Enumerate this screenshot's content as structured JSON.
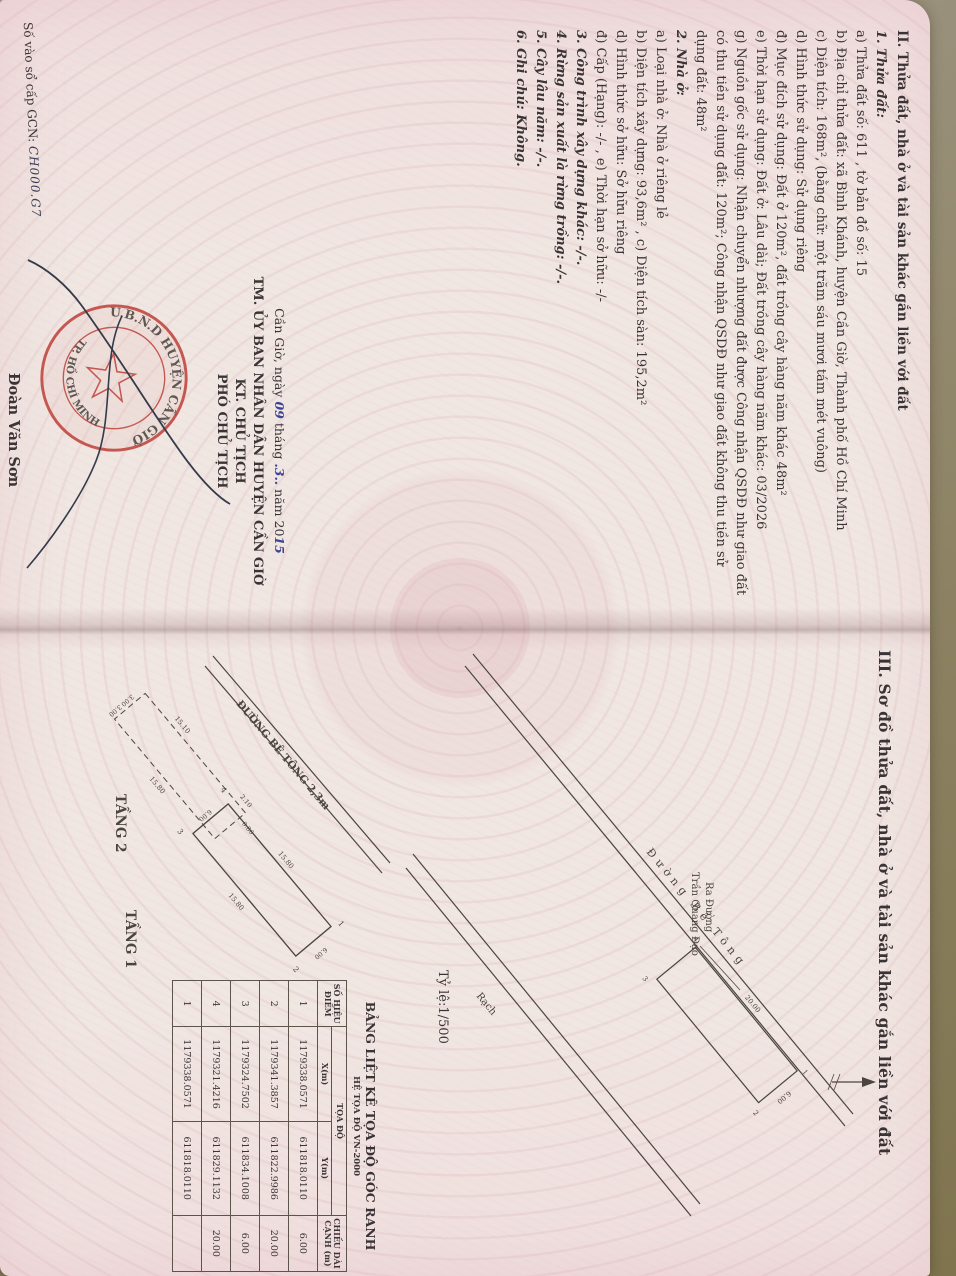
{
  "doc": {
    "section2": {
      "heading": "II. Thửa đất, nhà ở và tài sản khác gắn liền với đất",
      "items": [
        {
          "t": "1. Thửa đất:",
          "h": true
        },
        {
          "t": "a) Thửa đất số:   611   , tờ bản đồ số:   15"
        },
        {
          "t": "b) Địa chỉ thửa đất:  xã Bình Khánh, huyện Cần Giờ, Thành phố Hồ Chí Minh"
        },
        {
          "t": "c) Diện tích:   168m², (bằng chữ: một trăm sáu mươi tám mét vuông)"
        },
        {
          "t": "d) Hình thức sử dụng:   Sử dụng riêng"
        },
        {
          "t": "đ) Mục đích sử dụng:   Đất ở 120m², đất trồng cây hàng năm khác 48m²"
        },
        {
          "t": "e) Thời hạn sử dụng:   Đất ở: Lâu dài; Đất trồng cây hàng năm khác: 03/2026"
        },
        {
          "t": "g) Nguồn gốc sử dụng:  Nhận chuyển nhượng đất được Công nhận QSDĐ như giao đất có thu tiền sử dụng đất: 120m²; Công nhận QSDĐ như giao đất không thu tiền sử dụng đất: 48m²"
        },
        {
          "t": "2. Nhà ở:",
          "h": true
        },
        {
          "t": "a) Loại nhà ở:    Nhà ở riêng lẻ"
        },
        {
          "t": "b) Diện tích xây dựng:   93,6m²      , c) Diện tích sàn:   195,2m²"
        },
        {
          "t": "d) Hình thức sở hữu:    Sở hữu riêng"
        },
        {
          "t": "đ) Cấp (Hạng):  -/-      , e) Thời hạn sở hữu:   -/-"
        },
        {
          "t": "3. Công trình xây dựng khác:  -/-.",
          "h": true
        },
        {
          "t": "4. Rừng sản xuất là rừng trồng: -/-.",
          "h": true
        },
        {
          "t": "5. Cây lâu năm:  -/-.",
          "h": true
        },
        {
          "t": "6. Ghi chú: Không.",
          "h": true
        }
      ]
    },
    "signature": {
      "date_prefix": "Cần Giờ, ngày",
      "day": "09",
      "date_mid": "tháng",
      "month": ".3..",
      "date_suffix": "năm 20",
      "year": "15",
      "authority_1": "TM. ỦY BAN NHÂN DÂN HUYỆN CẦN GIỜ",
      "authority_2": "KT. CHỦ TỊCH",
      "authority_3": "PHÓ CHỦ TỊCH",
      "signer_name": "Đoàn Văn Sơn",
      "seal_top": "U.B.N.D HUYỆN CẦN GIỜ",
      "seal_bottom": "TP. HỒ CHÍ MINH"
    },
    "gcn": {
      "label": "Số vào sổ cấp GCN:",
      "value": "CH000.G7"
    },
    "section3": {
      "heading": "III. Sơ đồ thửa đất, nhà ở và tài sản khác gắn liền với đất",
      "scale": "Tỷ lệ:1/500"
    },
    "site_plan": {
      "road_label": "Đường Bê Tông",
      "canal_label": "Rạch",
      "exit_line1": "Ra Đường",
      "exit_line2": "Trần Quang Đạo",
      "parcel": {
        "c1": "1",
        "c2": "2",
        "c3": "3",
        "c4": "4",
        "d_top": "20.00",
        "d_side": "6.00"
      }
    },
    "floor_plans": {
      "road_label": "ĐƯỜNG BÊ TÔNG 2,3m",
      "tang2": {
        "label": "TẦNG 2",
        "d_top": "15.10",
        "d_bottom": "15.80",
        "d_l1": "3.00",
        "d_l2": "3.00",
        "d_r1": "2.10",
        "d_r2": "0.80"
      },
      "tang1": {
        "label": "TẦNG 1",
        "d_top": "15.80",
        "d_bottom": "15.80",
        "d_left": "6.00",
        "d_right": "6.00",
        "c1": "1",
        "c2": "2",
        "c3": "3",
        "c4": "4",
        "d_mid": "6.00"
      }
    },
    "table": {
      "title": "BẢNG LIỆT KÊ TỌA ĐỘ GÓC RANH",
      "subtitle": "HỆ TỌA ĐỘ VN-2000",
      "col_point": "SỐ HIỆU ĐIỂM",
      "col_coords": "TỌA ĐỘ",
      "col_x": "X(m)",
      "col_y": "Y(m)",
      "col_len": "CHIỀU DÀI CẠNH (m)",
      "rows": [
        {
          "stt": "1",
          "x": "1179338.0571",
          "y": "611818.0110",
          "d": "6.00"
        },
        {
          "stt": "2",
          "x": "1179341.3857",
          "y": "611822.9986",
          "d": "20.00"
        },
        {
          "stt": "3",
          "x": "1179324.7502",
          "y": "611834.1008",
          "d": "6.00"
        },
        {
          "stt": "4",
          "x": "1179321.4216",
          "y": "611829.1132",
          "d": "20.00"
        },
        {
          "stt": "1",
          "x": "1179338.0571",
          "y": "611818.0110",
          "d": ""
        }
      ]
    }
  }
}
